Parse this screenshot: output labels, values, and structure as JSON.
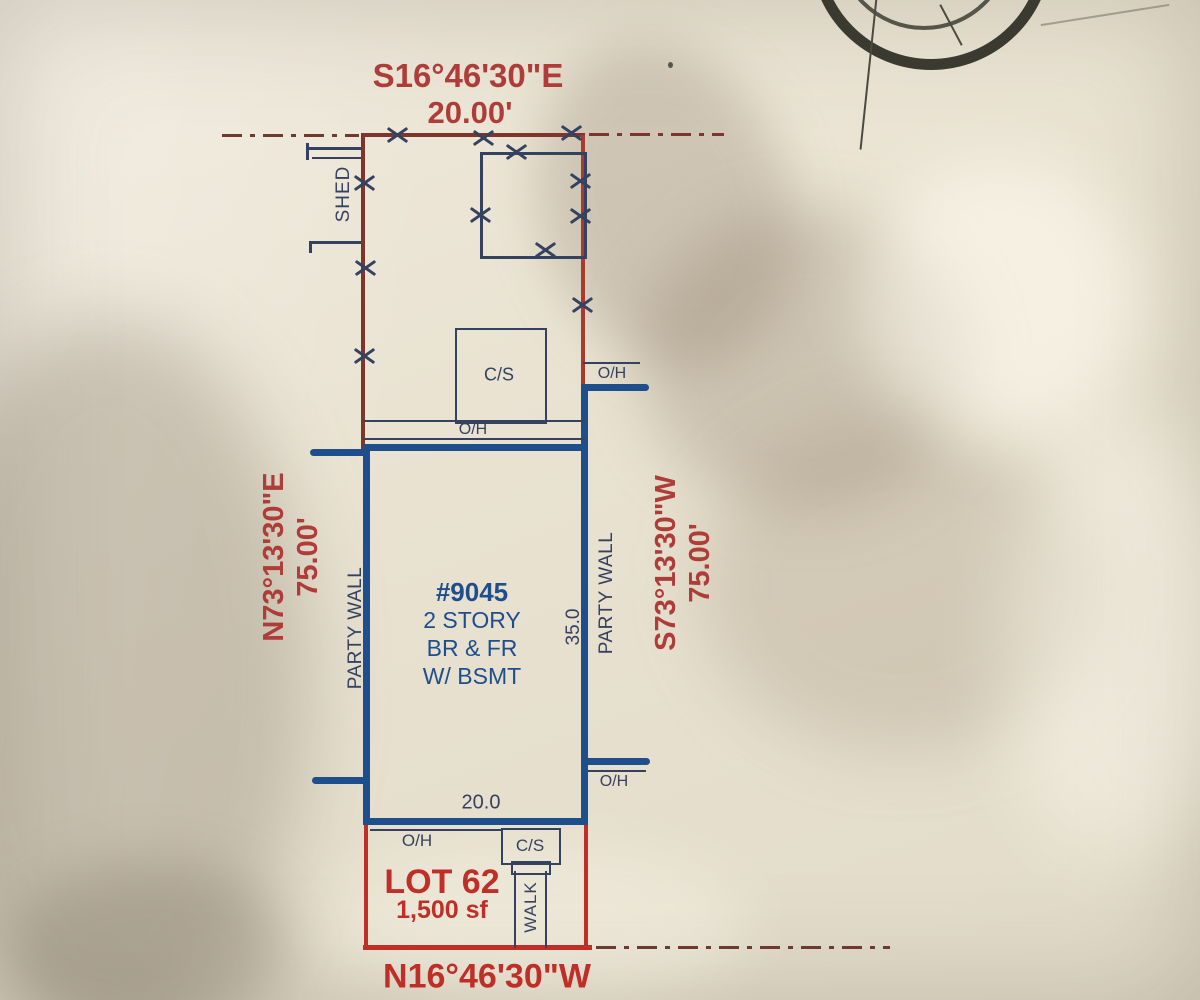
{
  "survey": {
    "bearings": {
      "north": {
        "bearing": "S16°46'30\"E",
        "distance": "20.00'"
      },
      "west": {
        "bearing": "N73°13'30\"E",
        "distance": "75.00'"
      },
      "east": {
        "bearing": "S73°13'30\"W",
        "distance": "75.00'"
      },
      "south": {
        "bearing": "N16°46'30\"W"
      }
    },
    "lot": {
      "name": "LOT 62",
      "area": "1,500 sf"
    },
    "building": {
      "house_number": "#9045",
      "desc_line1": "2 STORY",
      "desc_line2": "BR & FR",
      "desc_line3": "W/ BSMT",
      "depth_ft": "35.0",
      "width_ft": "20.0"
    },
    "labels": {
      "shed": "SHED",
      "walk": "WALK",
      "party_wall": "PARTY WALL",
      "overhang": "O/H",
      "concrete_stoop": "C/S"
    }
  },
  "colors": {
    "paper": "#e9e2d1",
    "dark_maroon": "#7d362b",
    "red_line": "#a83a30",
    "bright_red": "#bf2f27",
    "red_text": "#ae3c38",
    "building_blue": "#1e4e8c",
    "ink": "#35425f"
  }
}
